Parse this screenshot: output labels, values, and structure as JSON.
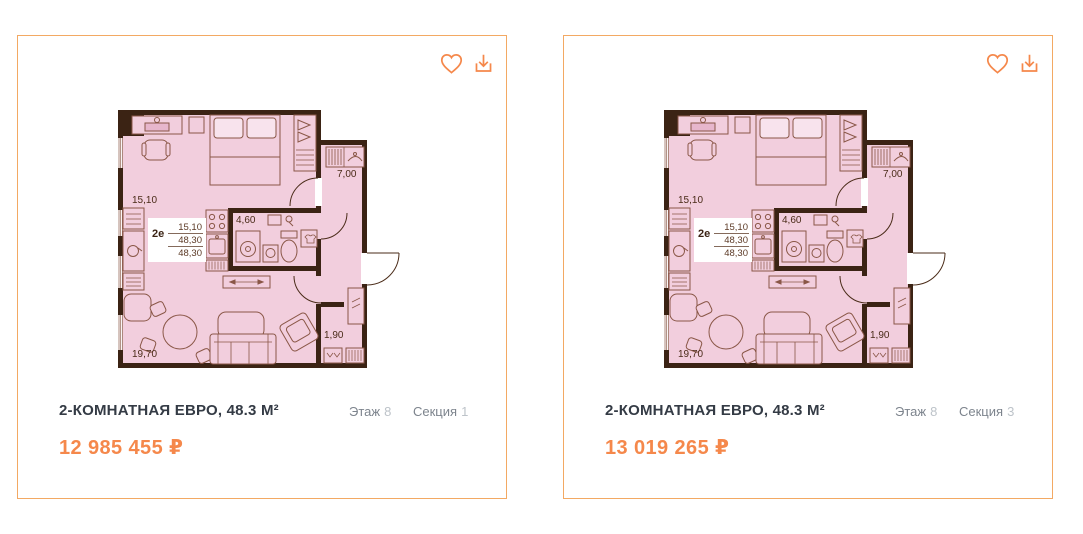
{
  "colors": {
    "accent_orange": "#F5884B",
    "card_border": "#F3A963",
    "plan_wall": "#3B2314",
    "plan_room_fill": "#F2CEDD",
    "plan_furniture_line": "#8A5747",
    "plan_dim_text": "#4A2B18",
    "title_text": "#343B45",
    "meta_label_gray": "#7D848D",
    "meta_value_gray": "#BDC3C9"
  },
  "icons": {
    "favorite": "heart-outline-icon",
    "download": "download-icon"
  },
  "plan": {
    "type_label": "2е",
    "stats": [
      "15,10",
      "48,30",
      "48,30"
    ],
    "dims": {
      "bedroom": "15,10",
      "hall": "7,00",
      "bath": "4,60",
      "living": "19,70",
      "wardrobe": "1,90"
    }
  },
  "cards": [
    {
      "title": "2-КОМНАТНАЯ ЕВРО, 48.3 М²",
      "floor_label": "Этаж",
      "floor_value": "8",
      "section_label": "Секция",
      "section_value": "1",
      "price": "12 985 455 ₽"
    },
    {
      "title": "2-КОМНАТНАЯ ЕВРО, 48.3 М²",
      "floor_label": "Этаж",
      "floor_value": "8",
      "section_label": "Секция",
      "section_value": "3",
      "price": "13 019 265 ₽"
    }
  ]
}
